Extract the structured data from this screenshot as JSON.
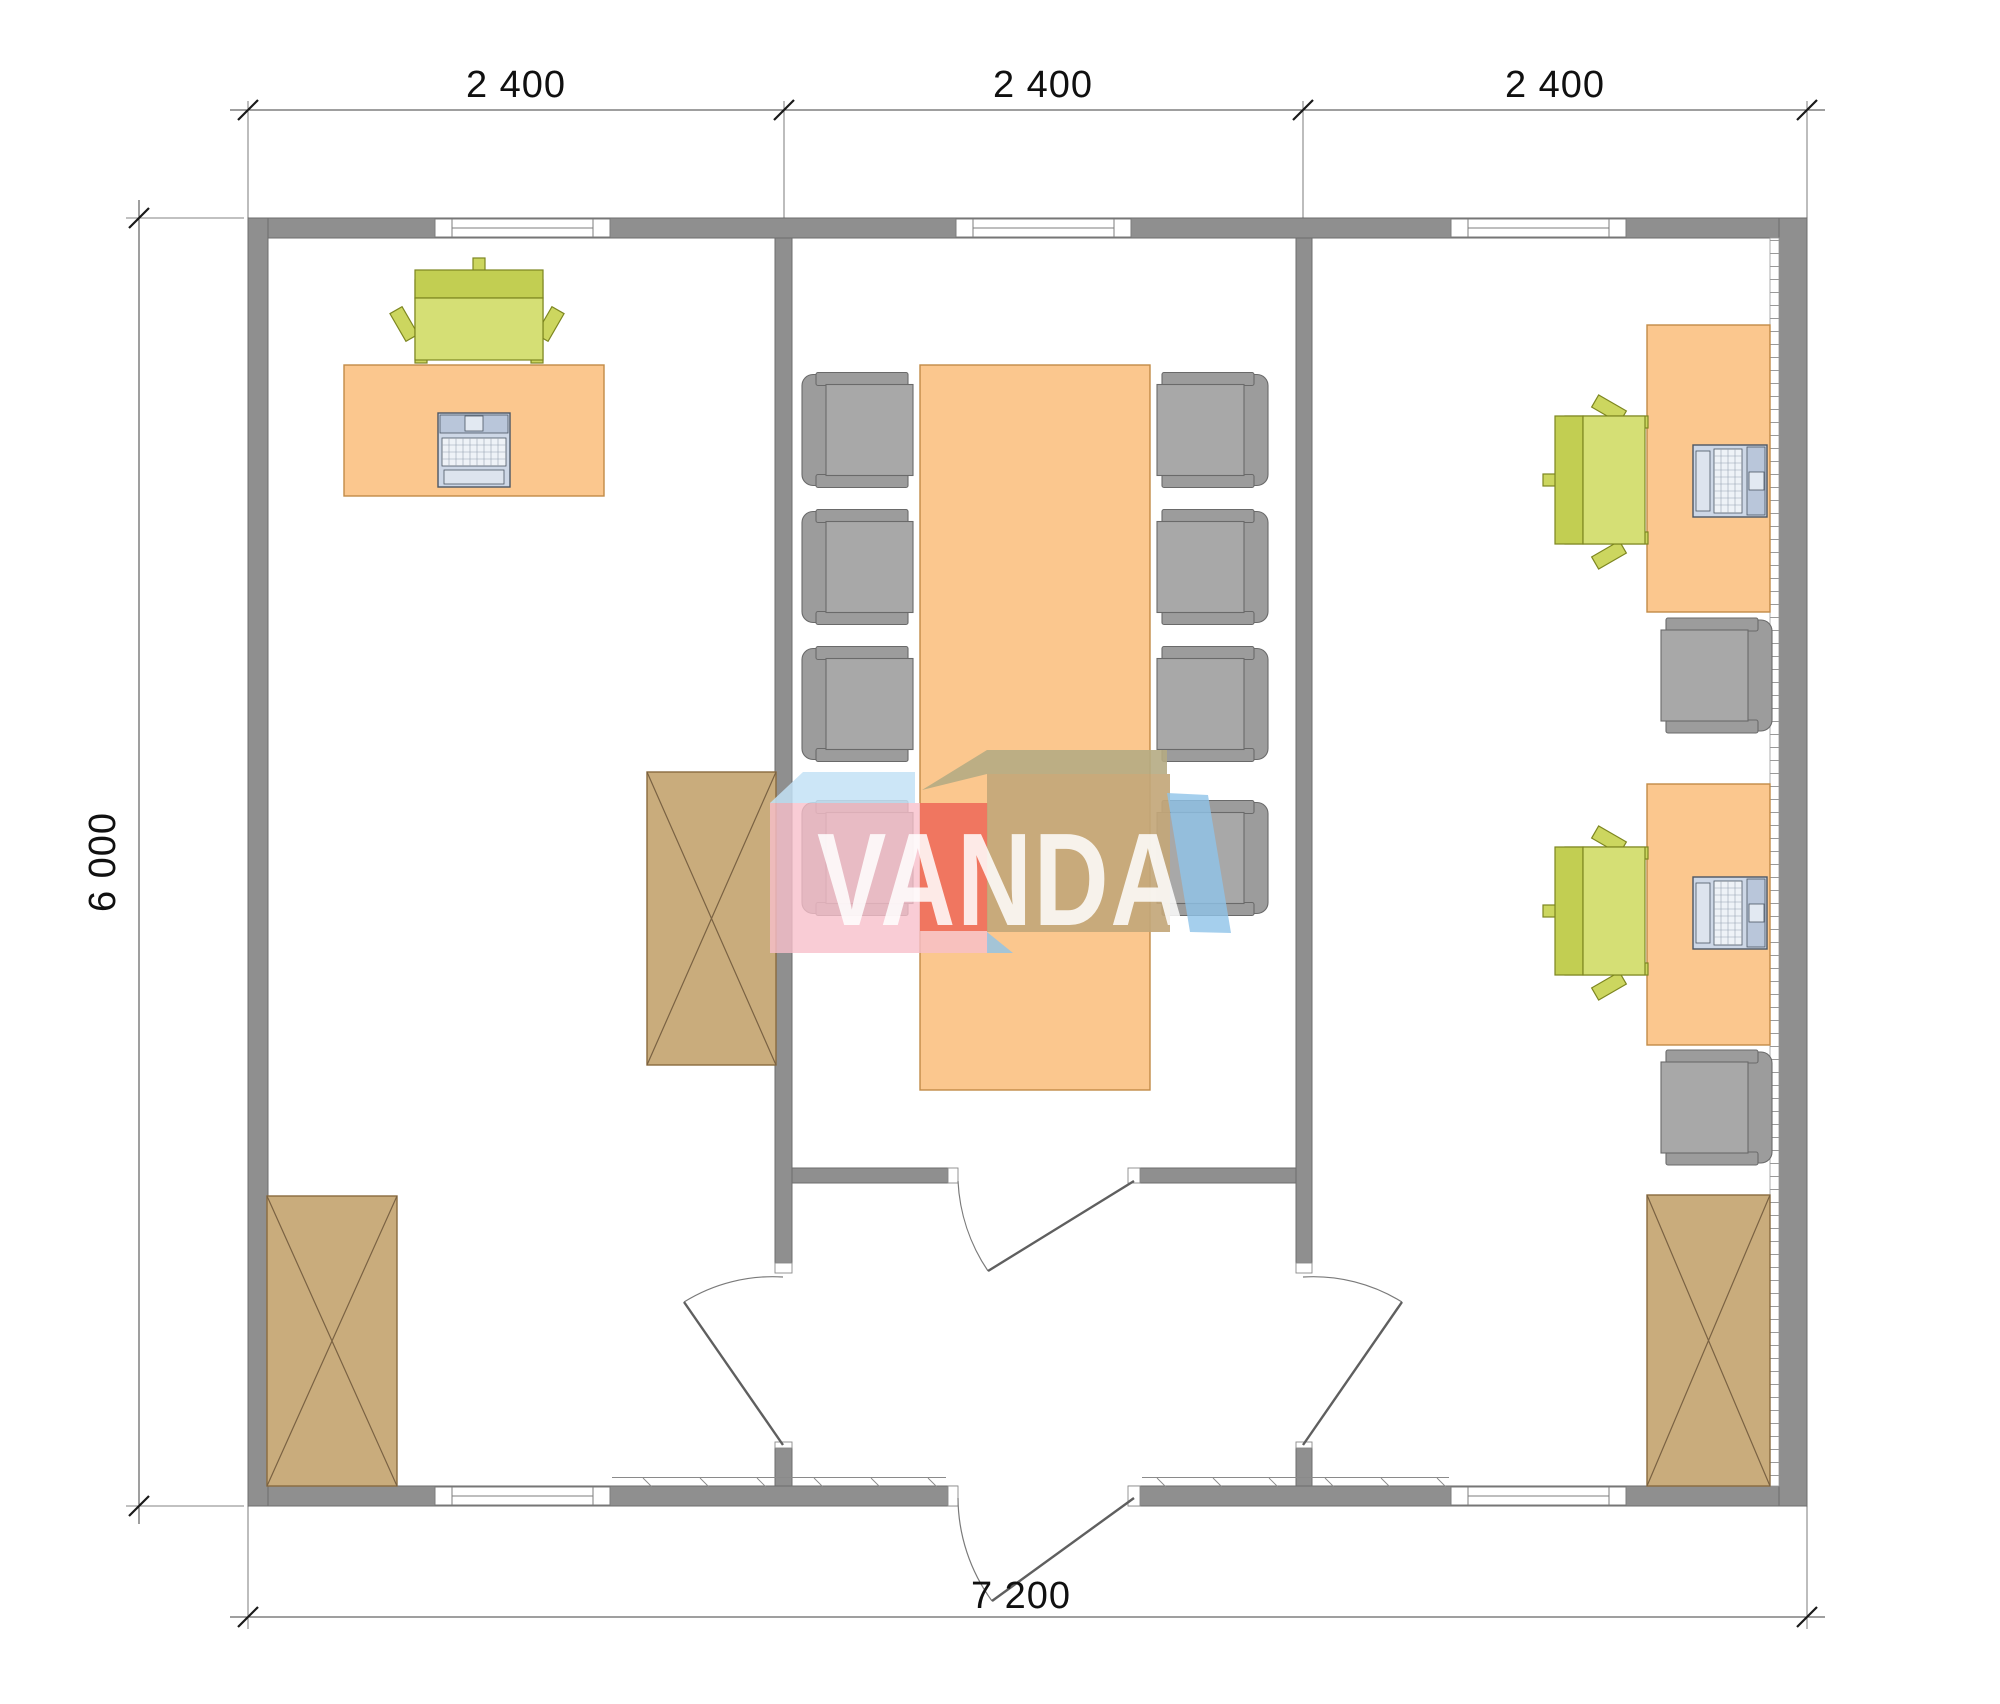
{
  "drawing": {
    "type": "floor-plan",
    "units_note": "millimetres",
    "dimensions": {
      "top": [
        "2 400",
        "2 400",
        "2 400"
      ],
      "left": "6 000",
      "bottom": "7 200"
    },
    "watermark": {
      "text": "VANDA"
    },
    "palette": {
      "wall_gray": "#8F8F8F",
      "desk_orange": "#FBC78E",
      "cabinet_tan": "#C9AC7C",
      "chair_green": "#CCD65F",
      "chair_gray": "#A6A6A6",
      "laptop_blue": "#CDD7E6",
      "logo_pink": "#F7BFCA",
      "logo_red_orange": "#EE6950",
      "logo_khaki": "#C3A77A",
      "logo_light_blue": "#C3E2F6",
      "logo_side_blue": "#8FC3E8",
      "dimension_text": "#101010"
    }
  }
}
